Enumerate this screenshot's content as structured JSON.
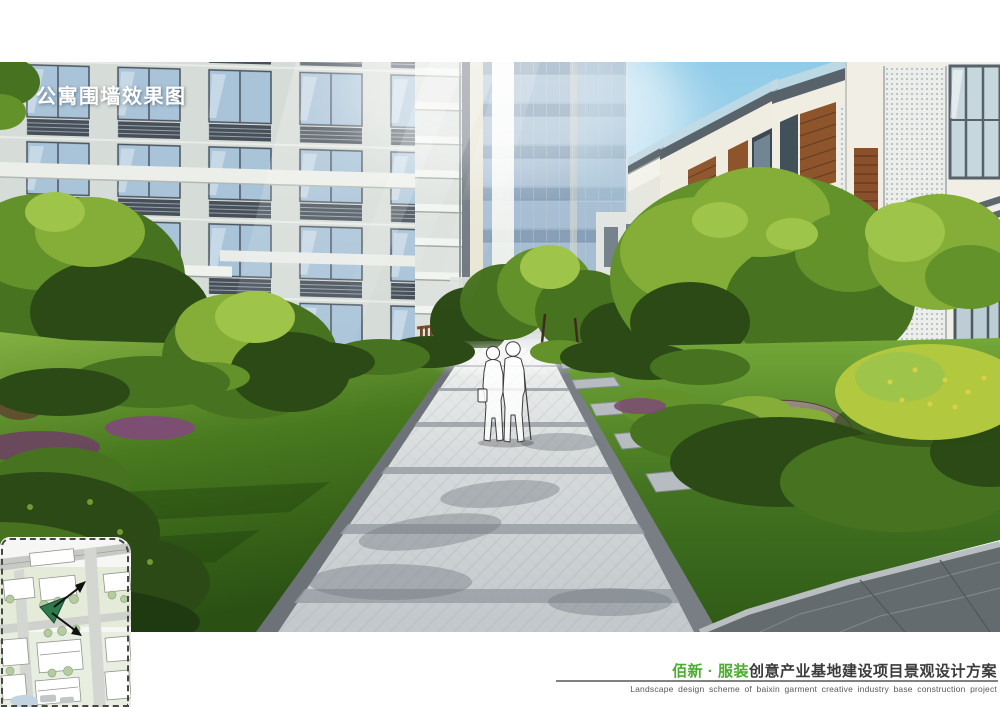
{
  "header": {
    "title": "公寓围墙效果图"
  },
  "footer": {
    "project_name_green": "佰新 · 服装",
    "project_name_dark": "创意产业基地建设项目景观设计方案",
    "caption_en": "Landscape design scheme of baixin garment creative industry base construction project"
  },
  "colors": {
    "accent_green": "#4aad2f",
    "footer_dark": "#3b3b3b",
    "footer_caption_gray": "#585858",
    "title_white": "#ffffff",
    "sky_top": "#8fcbe8",
    "sky_horizon": "#e2f1f8",
    "glass_blue": "#9db6cb",
    "facade_gray": "#d6dcd7",
    "facade_cream": "#f1efe5",
    "wood_fence_brown": "#8f5f3a",
    "louver_brown": "#8e552c",
    "lawn_green": "#48791f",
    "hedge_dark_green": "#2c4a15",
    "path_gray": "#d6dadb",
    "rock_gray": "#6f6058",
    "flower_purple": "#7b4e72"
  }
}
